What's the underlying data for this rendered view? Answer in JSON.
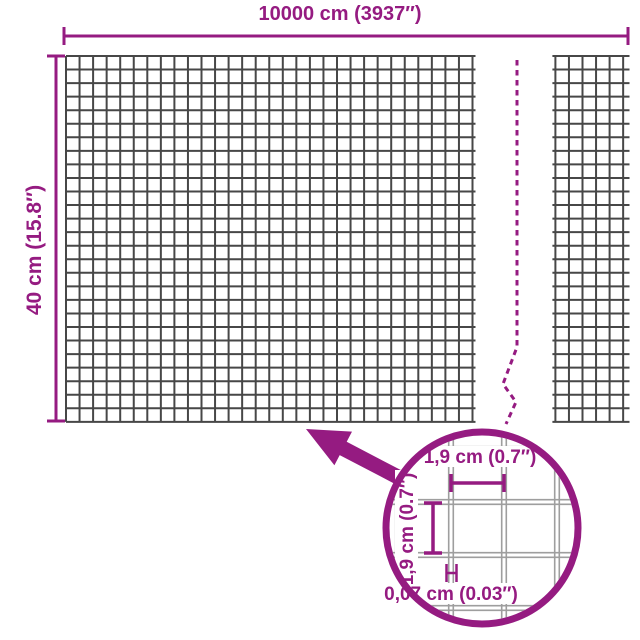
{
  "colors": {
    "accent": "#951b81",
    "mesh_line": "#474747",
    "lens_wire_line": "#9e9e9e",
    "background": "#ffffff"
  },
  "dimension_labels": {
    "total_width": "10000 cm (3937″)",
    "total_height": "40 cm (15.8″)"
  },
  "detail_labels": {
    "mesh_opening_width": "1,9 cm (0.7″)",
    "mesh_opening_height": "1,9 cm (0.7″)",
    "wire_thickness": "0,07 cm (0.03″)"
  }
}
